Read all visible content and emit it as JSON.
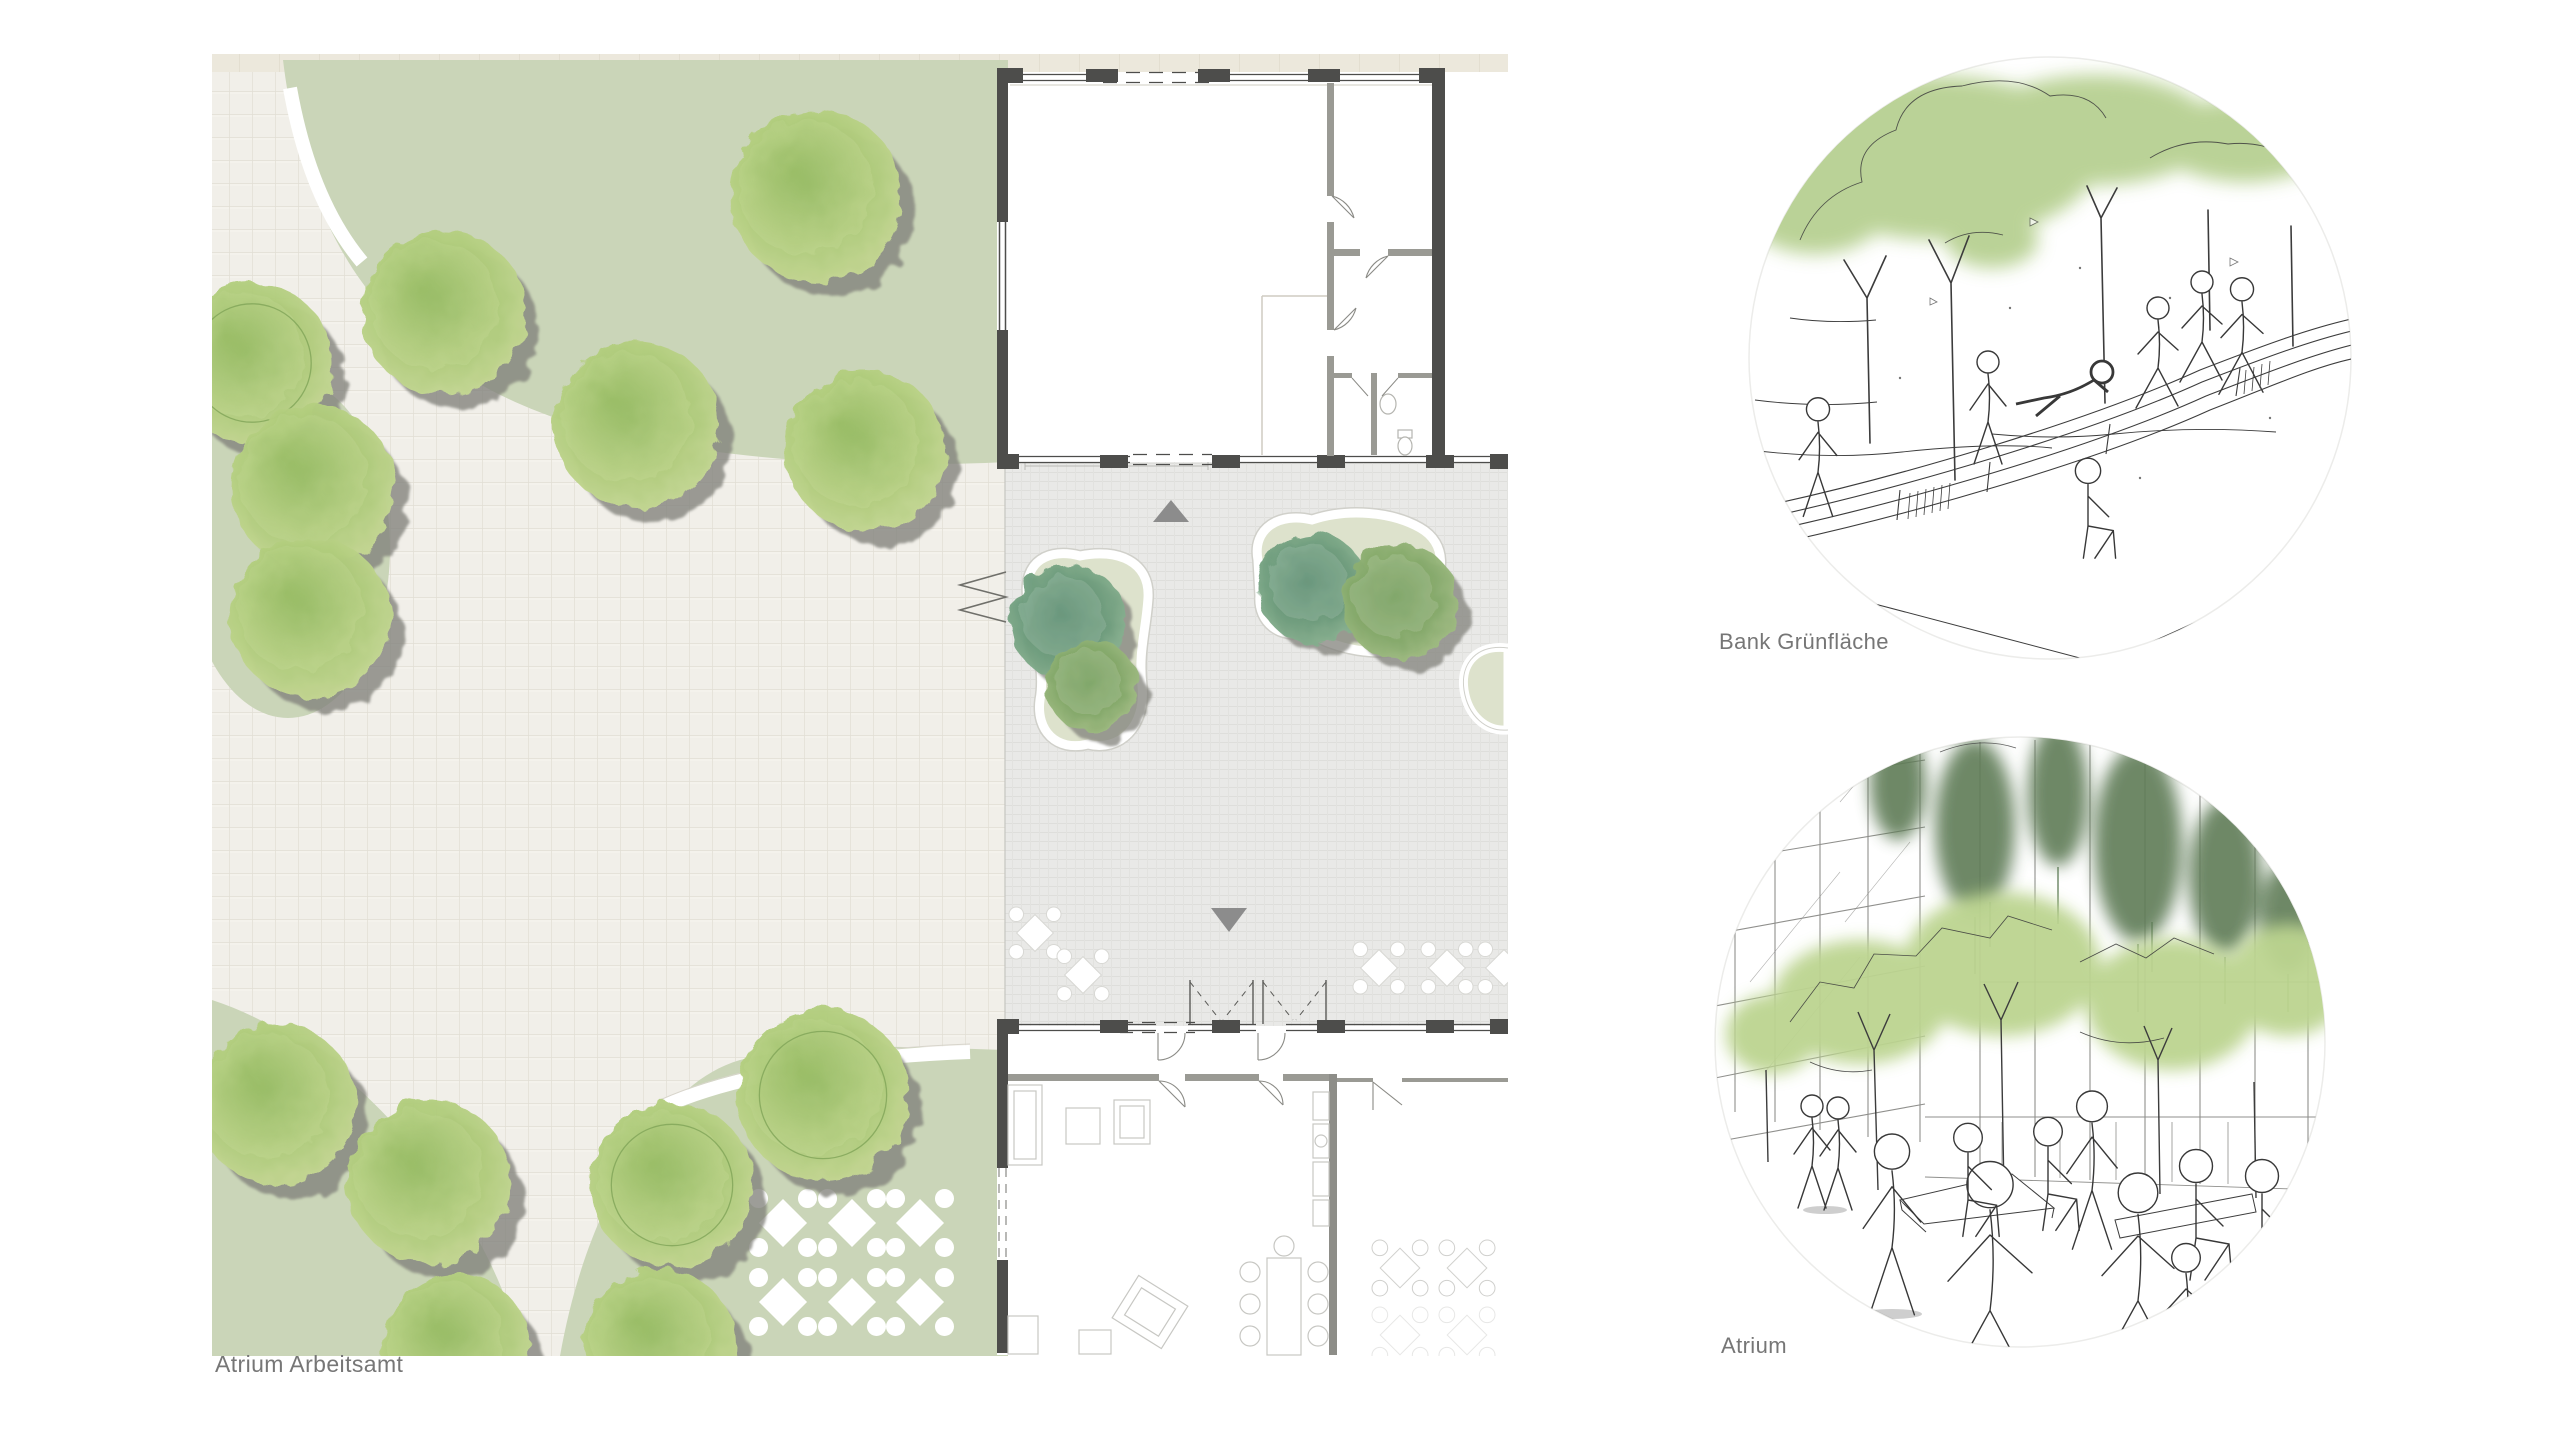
{
  "plan": {
    "label": "Atrium Arbeitsamt",
    "landscape_trees": [
      {
        "x": 816,
        "y": 196,
        "r": 86
      },
      {
        "x": 444,
        "y": 313,
        "r": 82
      },
      {
        "x": 637,
        "y": 425,
        "r": 83
      },
      {
        "x": 866,
        "y": 451,
        "r": 80
      },
      {
        "x": 252,
        "y": 363,
        "r": 80,
        "ring": true
      },
      {
        "x": 313,
        "y": 487,
        "r": 82
      },
      {
        "x": 310,
        "y": 617,
        "r": 80
      },
      {
        "x": 276,
        "y": 1104,
        "r": 80
      },
      {
        "x": 429,
        "y": 1182,
        "r": 82
      },
      {
        "x": 456,
        "y": 1348,
        "r": 74
      },
      {
        "x": 823,
        "y": 1095,
        "r": 86,
        "ring": true
      },
      {
        "x": 672,
        "y": 1185,
        "r": 82,
        "ring": true
      },
      {
        "x": 660,
        "y": 1345,
        "r": 76
      }
    ],
    "court_trees": [
      {
        "x": 1068,
        "y": 622,
        "r": 58,
        "c": "teal"
      },
      {
        "x": 1092,
        "y": 686,
        "r": 46,
        "c": "green"
      },
      {
        "x": 1313,
        "y": 588,
        "r": 55,
        "c": "teal"
      },
      {
        "x": 1400,
        "y": 602,
        "r": 58,
        "c": "green"
      }
    ],
    "lawn_tables": [
      [
        783,
        1223
      ],
      [
        852,
        1223
      ],
      [
        920,
        1223
      ],
      [
        783,
        1302
      ],
      [
        852,
        1302
      ],
      [
        920,
        1302
      ]
    ],
    "court_tables": [
      [
        1035,
        933
      ],
      [
        1083,
        975
      ],
      [
        1379,
        968
      ],
      [
        1447,
        968
      ],
      [
        1504,
        968
      ]
    ],
    "cafe_tables": [
      [
        1400,
        1268
      ],
      [
        1467,
        1268
      ],
      [
        1400,
        1335
      ],
      [
        1467,
        1335
      ]
    ]
  },
  "vignettes": [
    {
      "label": "Bank Grünfläche"
    },
    {
      "label": "Atrium"
    }
  ],
  "colors": {
    "lawn": "#cad5b8",
    "paving": "#f1efe9",
    "paving_grid": "#e1ded4",
    "band": "#ece8dc",
    "court_floor": "#e9e9e7",
    "wall_dark": "#4d4d4b",
    "wall_mid": "#8d8d88",
    "partition": "#9a9a94",
    "furniture": "#c7c7c3",
    "bed_fill": "#dde2cc",
    "tree_light": "#c7d996",
    "tree_mid": "#aecb79",
    "tree_core": "#8fb75c",
    "tree_shadow": "#82827c",
    "teal_core": "#54896a",
    "green_core": "#6f9c55",
    "arrow": "#8c8c8c",
    "label_text": "#767676",
    "ink": "#3c3c3c",
    "sketch_green": "#b7d092",
    "sketch_dark_green": "#5e7c57"
  }
}
